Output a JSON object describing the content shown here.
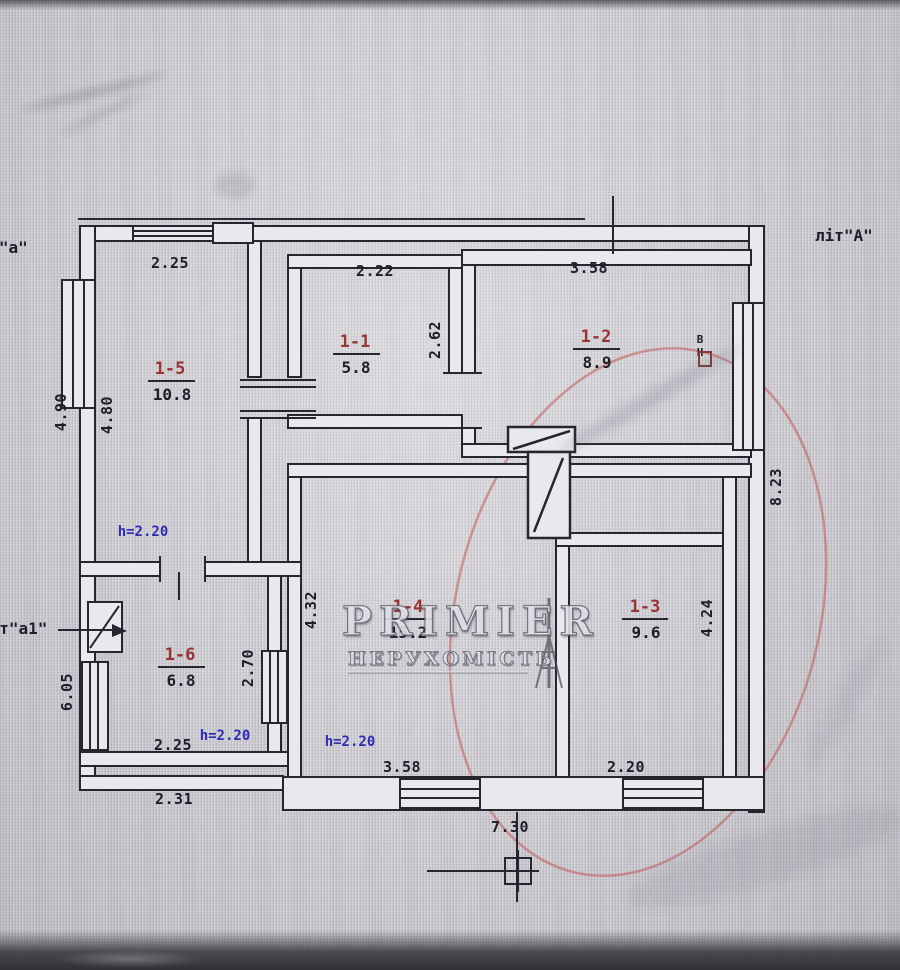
{
  "photo": {
    "building_labels": {
      "top_left": "літ\"а\"",
      "top_right": "літ\"А\"",
      "side_left": "літ\"а1\""
    },
    "watermark": {
      "title": "PRIMIER",
      "subtitle": "НЕРУХОМІСТЬ"
    },
    "marker_vn": "ВН",
    "ceiling_height_label": "h=2.20",
    "rooms": [
      {
        "number": "1-1",
        "area": "5.8"
      },
      {
        "number": "1-2",
        "area": "8.9"
      },
      {
        "number": "1-3",
        "area": "9.6"
      },
      {
        "number": "1-4",
        "area": "15.2"
      },
      {
        "number": "1-5",
        "area": "10.8"
      },
      {
        "number": "1-6",
        "area": "6.8"
      }
    ],
    "dimensions": {
      "room15_width": "2.25",
      "room11_width": "2.22",
      "room12_width": "3.58",
      "left_outer_height": "4.90",
      "room15_height": "4.80",
      "room11_height": "2.62",
      "right_outer_height": "8.23",
      "room14_height": "4.32",
      "room13_height": "4.24",
      "room16_height": "2.70",
      "left_lower_height": "6.05",
      "room16_width": "2.25",
      "bottom_left_width": "2.31",
      "room14_width": "3.58",
      "room13_window_width": "2.20",
      "bottom_total_width": "7.30"
    }
  }
}
